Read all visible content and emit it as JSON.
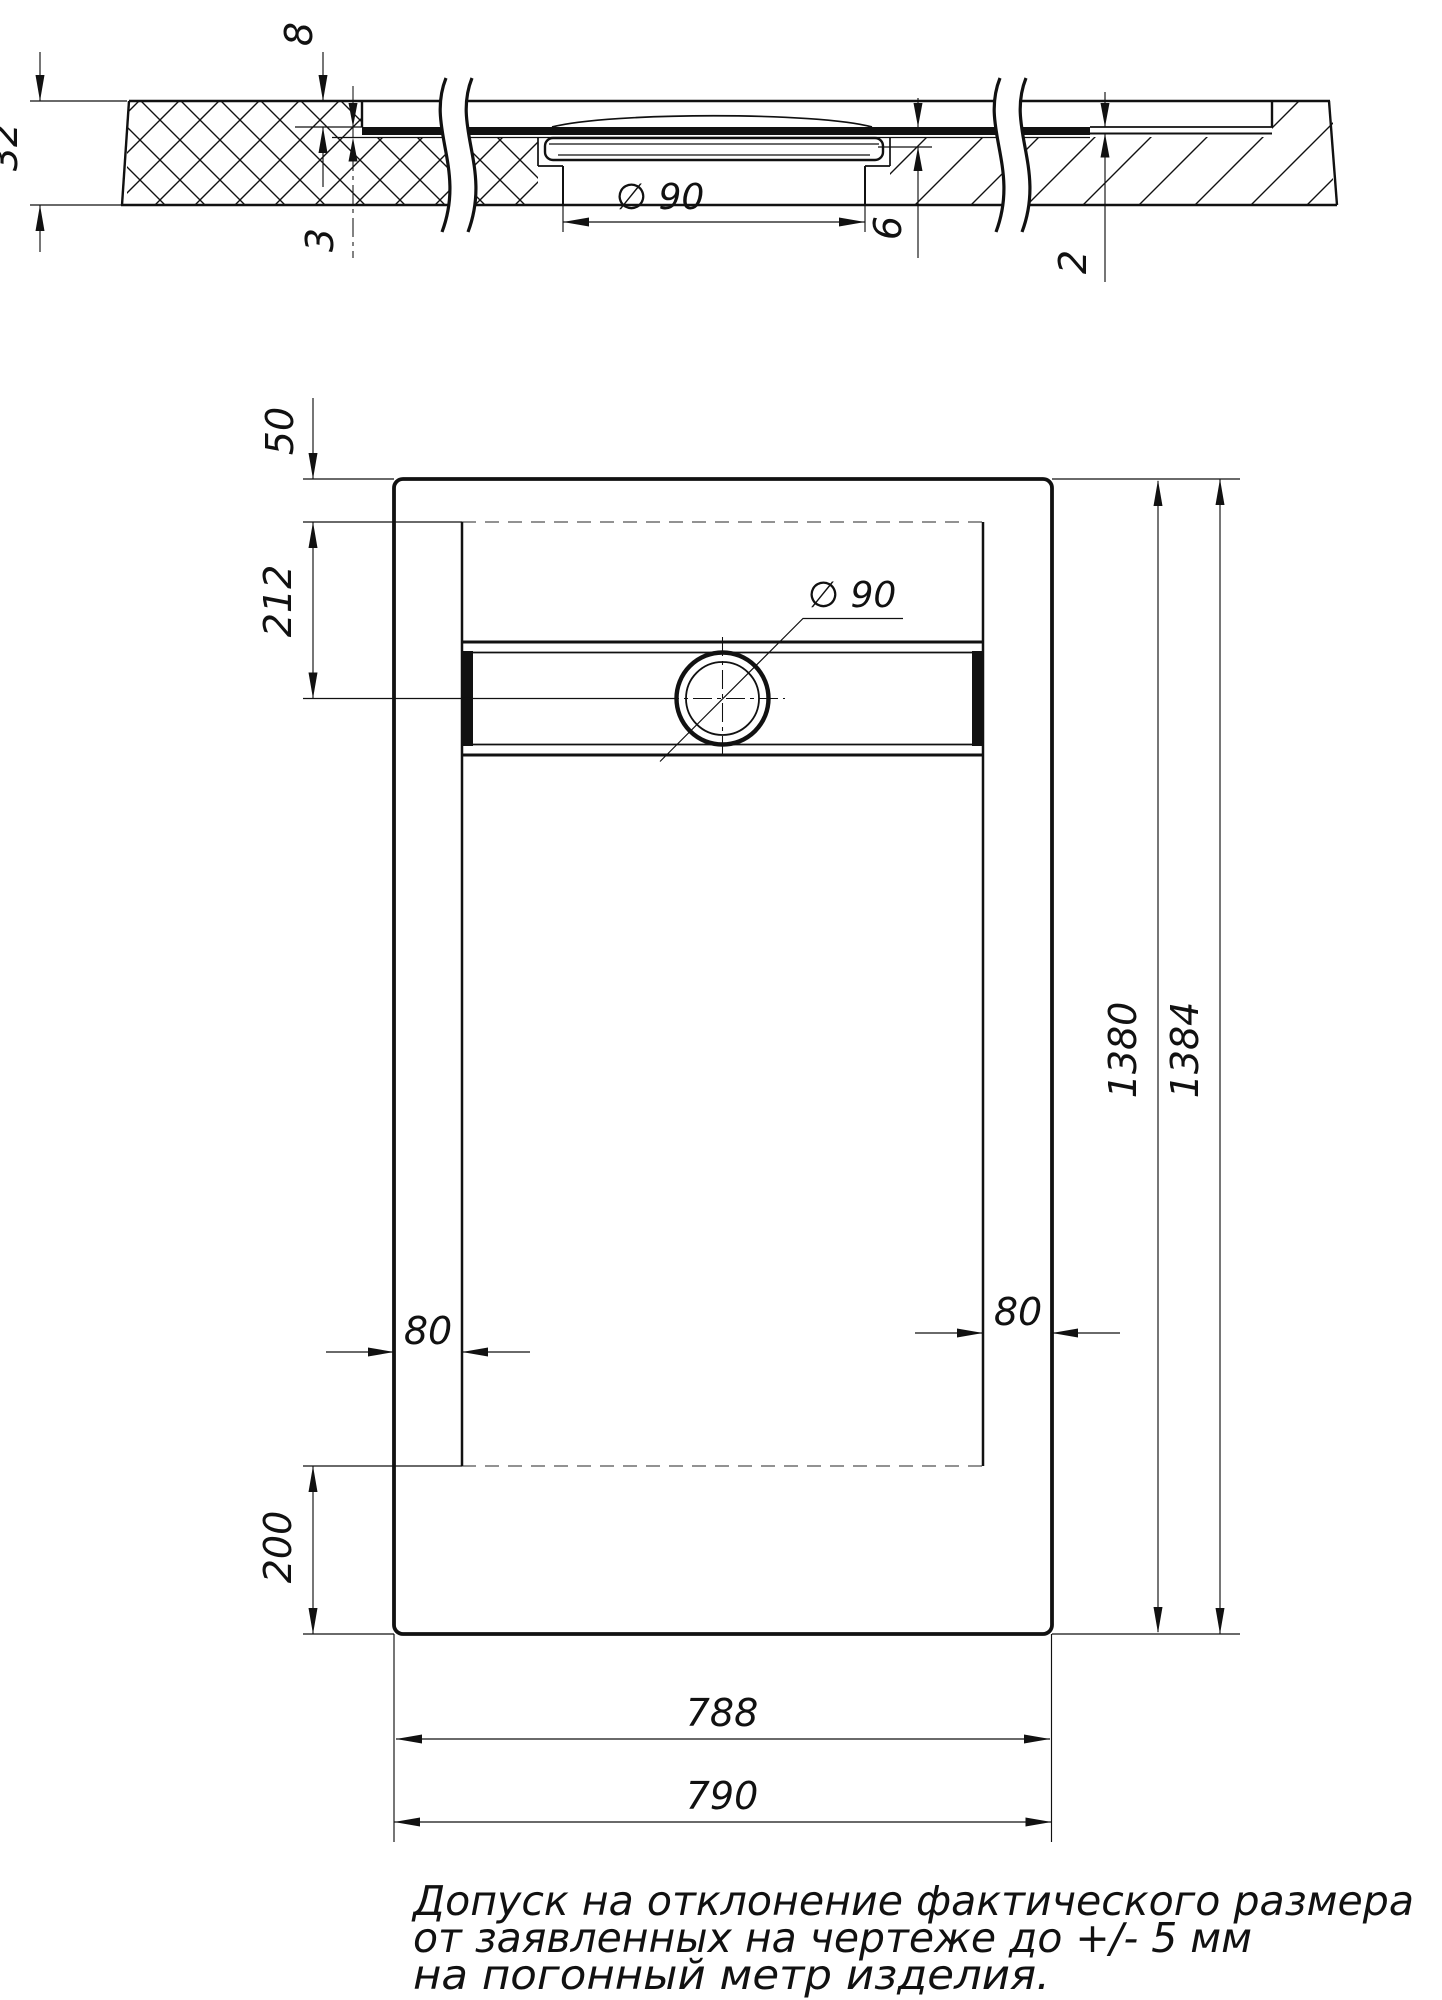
{
  "page": {
    "background": "#ffffff",
    "line_color": "#111111",
    "hidden_line_color": "#6e6e6e"
  },
  "section_view": {
    "dim_32": "32",
    "dim_8": "8",
    "dim_3": "3",
    "dim_diameter": "∅ 90",
    "dim_6": "6",
    "dim_2": "2"
  },
  "plan_view": {
    "dim_50": "50",
    "dim_212": "212",
    "dim_diameter": "∅ 90",
    "dim_80_left": "80",
    "dim_80_right": "80",
    "dim_200": "200",
    "dim_1380": "1380",
    "dim_1384": "1384",
    "dim_788": "788",
    "dim_790": "790"
  },
  "notes": [
    "Допуск на отклонение фактического размера",
    "от заявленных на чертеже до +/- 5 мм",
    "на погонный метр изделия."
  ]
}
